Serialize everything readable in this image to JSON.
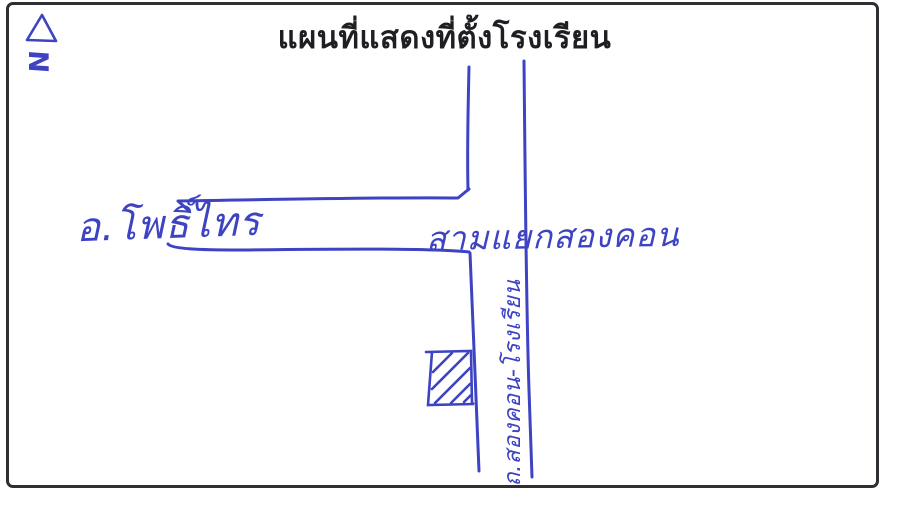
{
  "document": {
    "title": "แผนที่แสดงที่ตั้งโรงเรียน"
  },
  "compass": {
    "letter": "N",
    "symbol": "triangle-outline"
  },
  "map": {
    "road_label_west": "อ.โพธิ์ไทร",
    "intersection_label": "สามแยกสองคอน",
    "school_road_label": "ถ.สองคอน-โรงเรียน",
    "school_marker": "hatched-square",
    "junction_type": "T-junction"
  },
  "colors": {
    "ink": "#3d43c2",
    "title": "#1f1f23",
    "frame": "#2e2e33",
    "paper": "#ffffff"
  }
}
